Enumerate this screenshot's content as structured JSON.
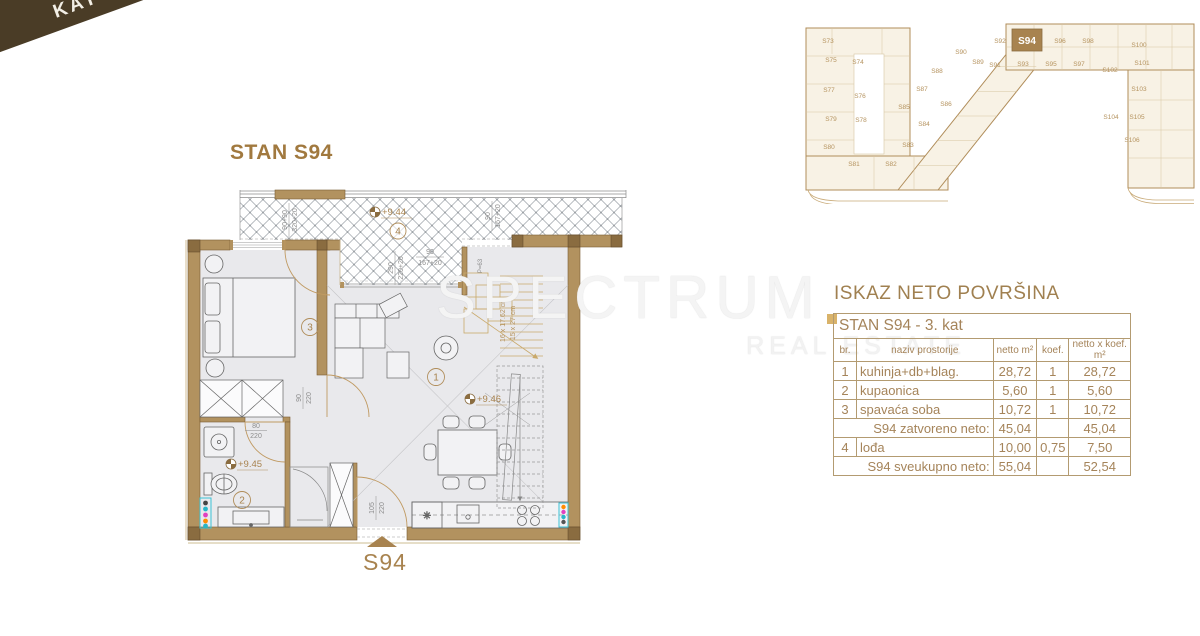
{
  "ribbon": {
    "label": "KAT 3"
  },
  "page": {
    "title": "STAN S94"
  },
  "watermark": {
    "line1": "SPECTRUM",
    "line2": "REAL ESTATE"
  },
  "plan": {
    "marker": "S94",
    "rooms": {
      "living": "1",
      "bath": "2",
      "bedroom": "3",
      "loggia": "4"
    },
    "levels": {
      "loggia": "+9.44",
      "bath": "+9.45",
      "living": "+9.46"
    },
    "dims": {
      "d1a": "90+90",
      "d1b": "320+20",
      "d2a": "290",
      "d2b": "220+20",
      "d3a": "90",
      "d3b": "167+20",
      "d4a": "90",
      "d4b": "167+20",
      "door_bedroom_a": "90",
      "door_bedroom_b": "220",
      "door_bath_a": "80",
      "door_bath_b": "220",
      "door_entry_a": "105",
      "door_entry_b": "220",
      "stair1": "16 x 17.62 cm",
      "stair2": "15 x 27 cm",
      "pdim": "P=63"
    }
  },
  "siteplan": {
    "highlight": "S94",
    "units": [
      "S73",
      "S74",
      "S75",
      "S76",
      "S77",
      "S78",
      "S79",
      "S80",
      "S81",
      "S82",
      "S83",
      "S84",
      "S85",
      "S86",
      "S87",
      "S88",
      "S89",
      "S90",
      "S91",
      "S92",
      "S93",
      "S95",
      "S96",
      "S97",
      "S98",
      "S100",
      "S101",
      "S102",
      "S103",
      "S104",
      "S105",
      "S106"
    ]
  },
  "table": {
    "title": "ISKAZ NETO POVRŠINA",
    "subtitle": "STAN S94 - 3. kat",
    "headers": [
      "br.",
      "naziv prostorije",
      "netto m²",
      "koef.",
      "netto x koef. m²"
    ],
    "rows": [
      {
        "type": "data",
        "br": "1",
        "naziv": "kuhinja+db+blag.",
        "netto": "28,72",
        "koef": "1",
        "nxk": "28,72"
      },
      {
        "type": "data",
        "br": "2",
        "naziv": "kupaonica",
        "netto": "5,60",
        "koef": "1",
        "nxk": "5,60"
      },
      {
        "type": "data",
        "br": "3",
        "naziv": "spavaća soba",
        "netto": "10,72",
        "koef": "1",
        "nxk": "10,72"
      },
      {
        "type": "subtotal",
        "naziv": "S94 zatvoreno neto:",
        "netto": "45,04",
        "koef": "",
        "nxk": "45,04"
      },
      {
        "type": "data",
        "br": "4",
        "naziv": "lođa",
        "netto": "10,00",
        "koef": "0,75",
        "nxk": "7,50"
      },
      {
        "type": "subtotal",
        "naziv": "S94 sveukupno neto:",
        "netto": "55,04",
        "koef": "",
        "nxk": "52,54"
      }
    ]
  },
  "colors": {
    "tan": "#b08d5a",
    "dark_tan": "#a8834f",
    "wall": "#b2925f",
    "ribbon_dark": "#4a3c26",
    "ribbon_tan": "#b8915c",
    "gold": "#d9b36a",
    "floor": "#e9e9ec"
  }
}
